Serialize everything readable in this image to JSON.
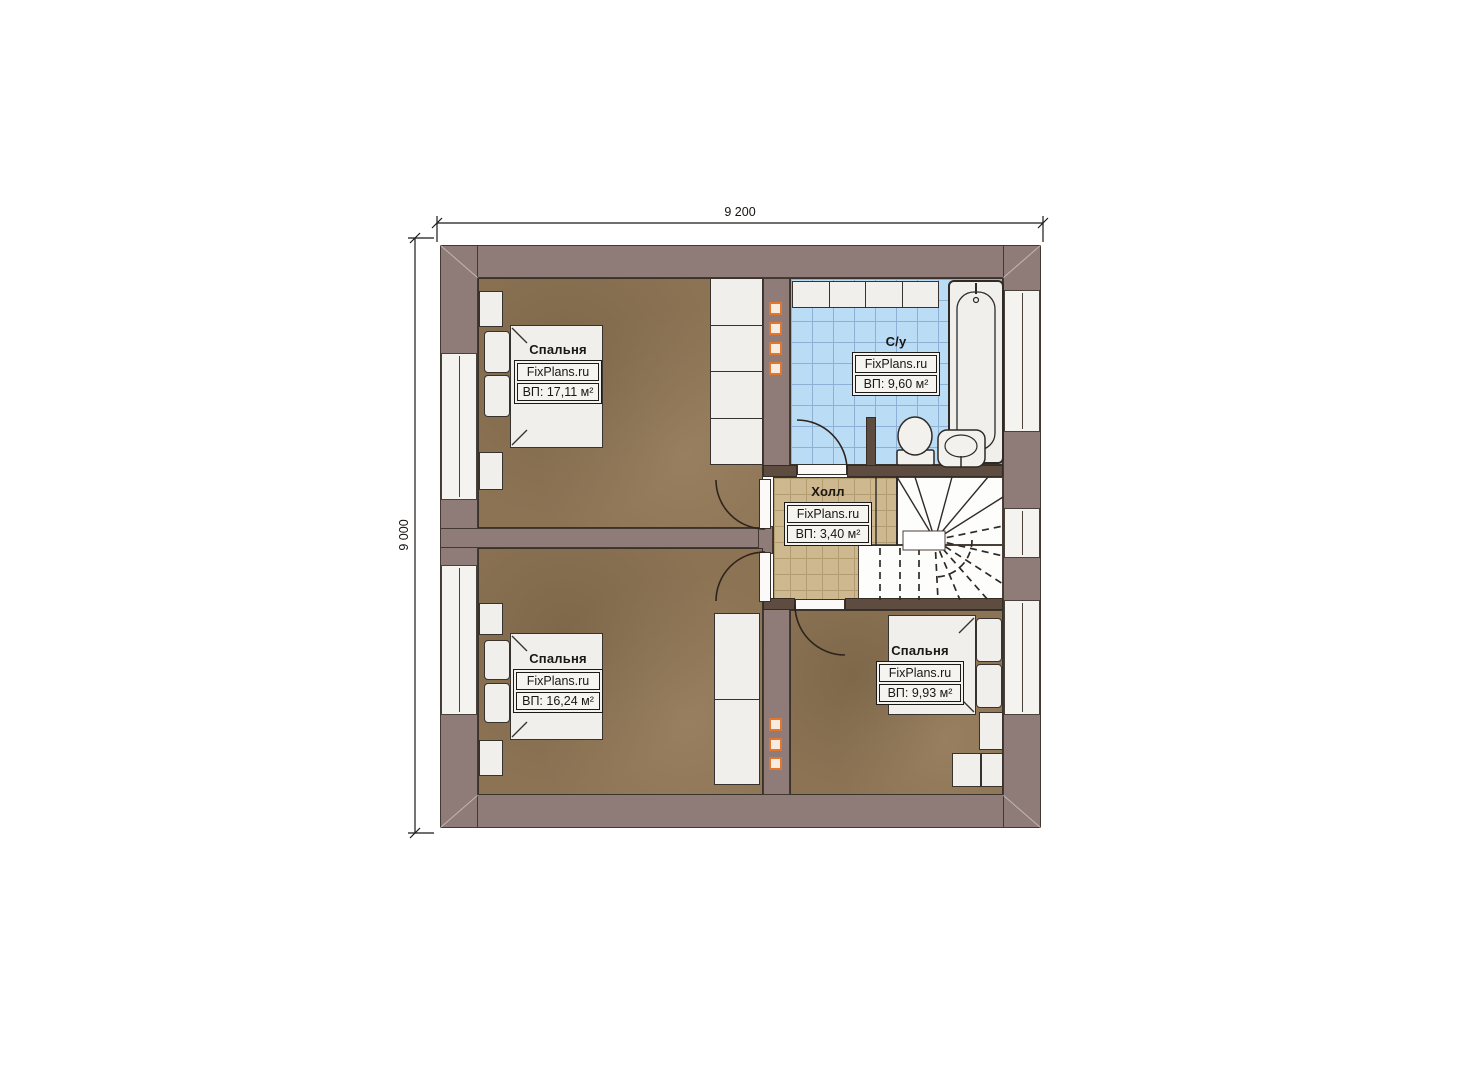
{
  "plan": {
    "title": "second-floor-plan",
    "dimensions": {
      "top": "9 200",
      "left": "9 000"
    },
    "rooms": {
      "bedroom_top_left": {
        "name": "Спальня",
        "brand": "FixPlans.ru",
        "area": "ВП: 17,11 м²"
      },
      "bathroom": {
        "name": "С/у",
        "brand": "FixPlans.ru",
        "area": "ВП: 9,60 м²"
      },
      "hall": {
        "name": "Холл",
        "brand": "FixPlans.ru",
        "area": "ВП: 3,40 м²"
      },
      "bedroom_bottom_left": {
        "name": "Спальня",
        "brand": "FixPlans.ru",
        "area": "ВП: 16,24 м²"
      },
      "bedroom_bottom_right": {
        "name": "Спальня",
        "brand": "FixPlans.ru",
        "area": "ВП: 9,93 м²"
      }
    },
    "colors": {
      "wall": "#8f7b77",
      "wall_dark": "#5f4c41",
      "floor_wood": "#8c7354",
      "tile_bath": "#badcf4",
      "tile_hall": "#cdb88f",
      "furniture": "#f0efec",
      "accent_orange": "#e2762f"
    }
  }
}
